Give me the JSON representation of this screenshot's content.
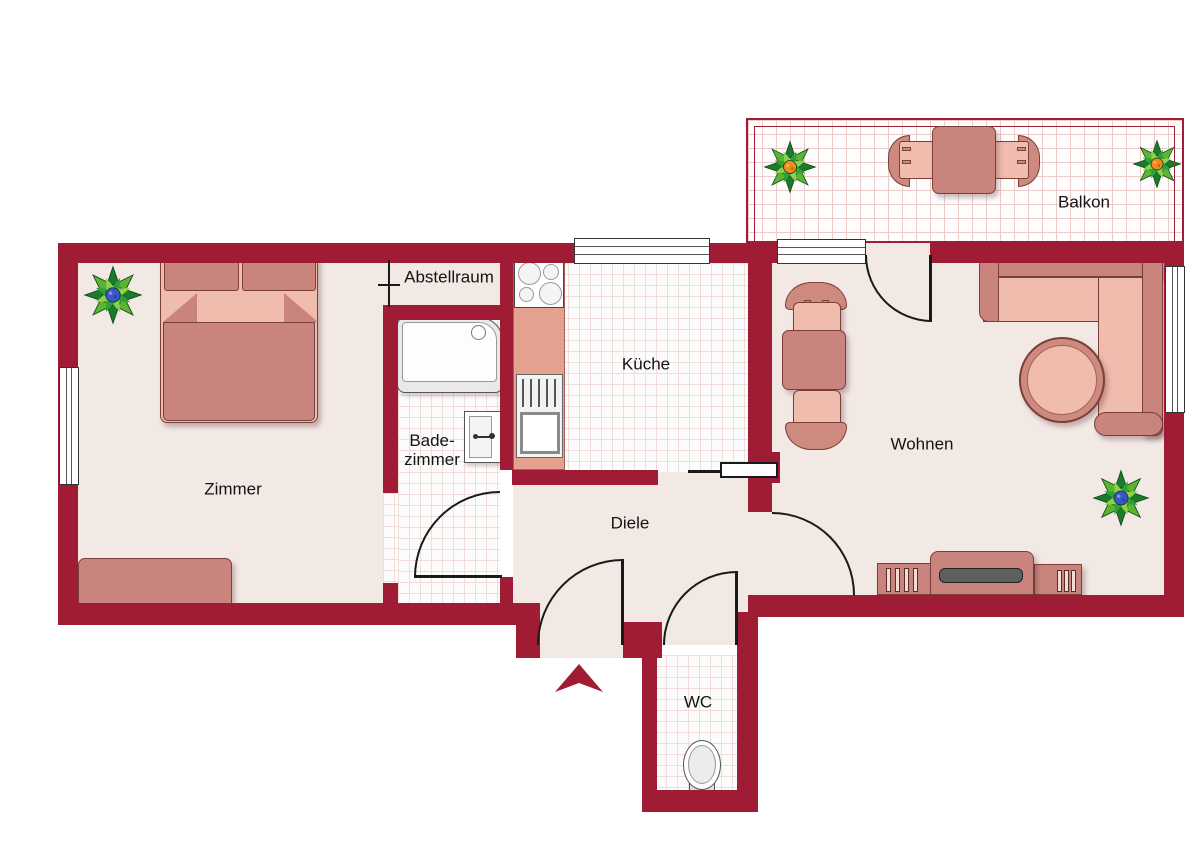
{
  "rooms": {
    "zimmer": {
      "label": "Zimmer"
    },
    "abstellraum": {
      "label": "Abstellraum"
    },
    "badezimmer": {
      "lines": [
        "Bade-",
        "zimmer"
      ]
    },
    "kueche": {
      "label": "Küche"
    },
    "diele": {
      "label": "Diele"
    },
    "wc": {
      "label": "WC"
    },
    "wohnen": {
      "label": "Wohnen"
    },
    "balkon": {
      "label": "Balkon"
    }
  },
  "colors": {
    "wall": "#a01c35",
    "floor": "#f2e8e4",
    "tile-line": "#f0dcd8",
    "balcony-tile-line": "#eccaca",
    "furn-dark": "#c9857d",
    "furn-mid": "#cf8a80",
    "furn-light": "#f0bcae",
    "furn-outline": "#7a3f38",
    "counter": "#e5a18f",
    "screen": "#5f5f5f",
    "line": "#1a1a1a",
    "plant-center-blue": "#3a57c9",
    "plant-center-orange": "#ef8b1a"
  },
  "furniture": {
    "zimmer": [
      "double-bed",
      "bench",
      "plant"
    ],
    "badezimmer": [
      "bathtub",
      "washbasin"
    ],
    "kueche": [
      "stove",
      "kitchen-counter",
      "kitchen-sink"
    ],
    "wc": [
      "toilet"
    ],
    "wohnen": [
      "dining-table",
      "two-chairs",
      "corner-sofa",
      "round-table",
      "tv-sideboard",
      "plant"
    ],
    "balkon": [
      "table",
      "two-chairs",
      "two-plants"
    ]
  }
}
